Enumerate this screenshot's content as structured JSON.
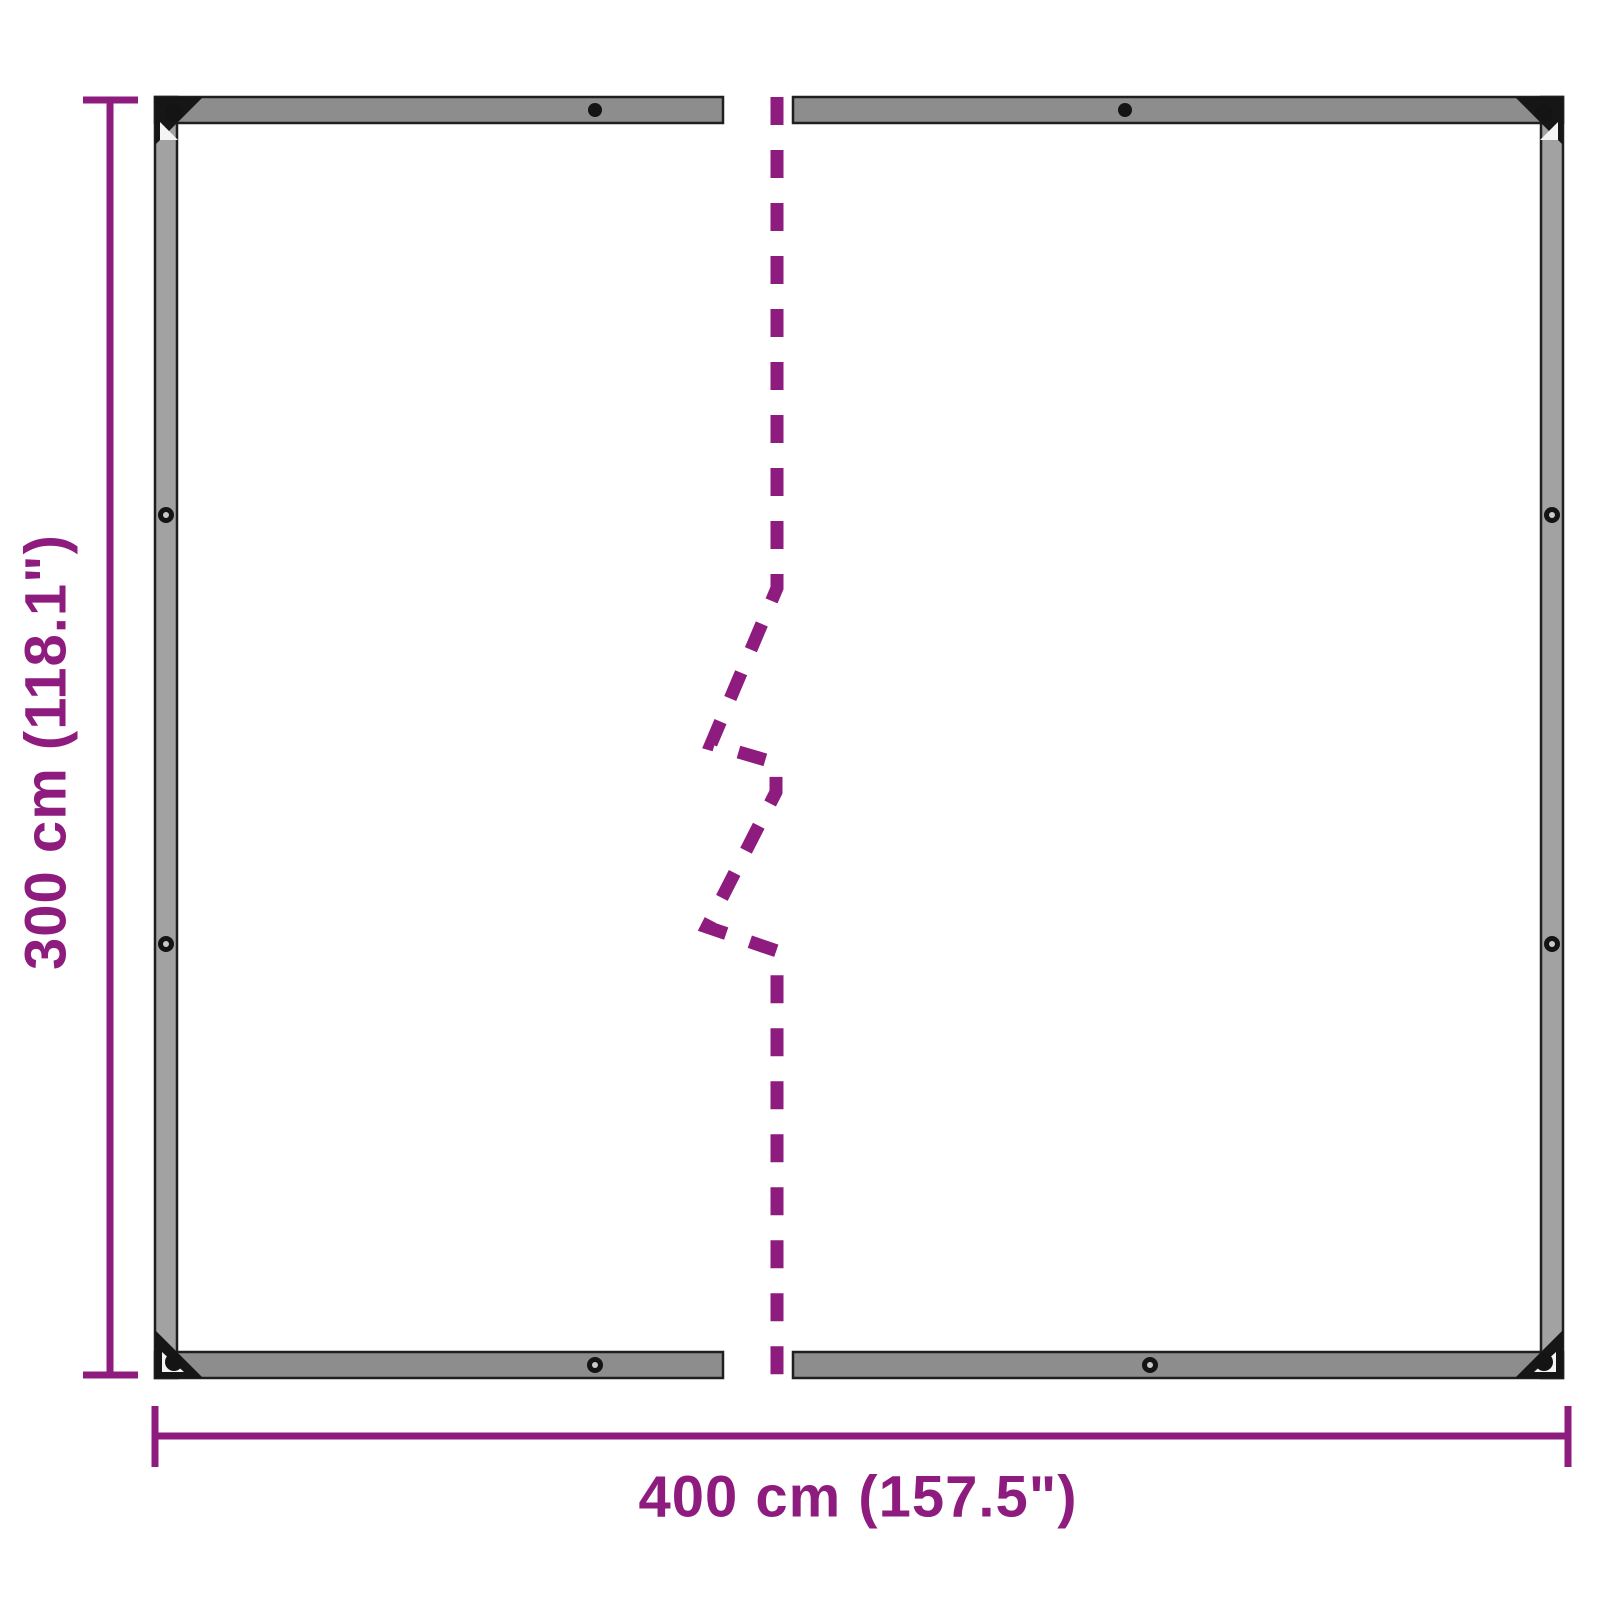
{
  "colors": {
    "dimension": "#8e1b7e",
    "hem": "#a2a2a2",
    "hem_dark": "#8d8d8d",
    "outline": "#1f1f1f",
    "grommet": "#141414",
    "background": "#ffffff"
  },
  "diagram": {
    "type": "product-dimension-diagram",
    "subject": "clear tarpaulin with eyelets shown in two halves with break line",
    "height_label": "300 cm (118.1\")",
    "width_label": "400 cm (157.5\")"
  }
}
